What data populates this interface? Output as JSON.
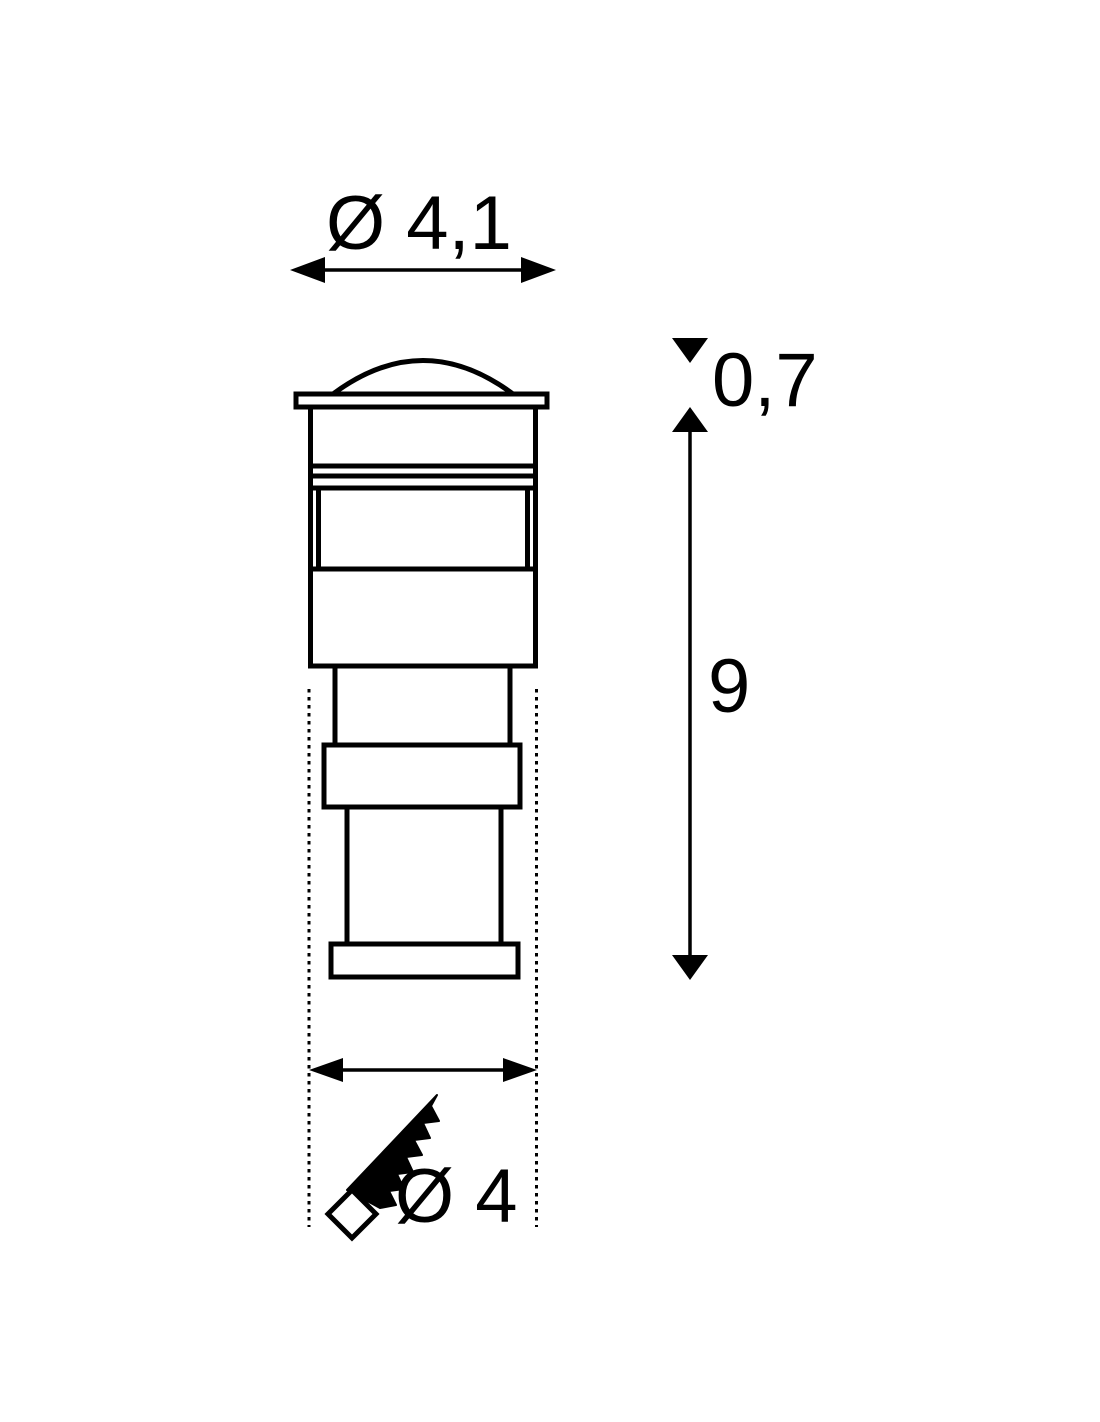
{
  "canvas": {
    "background": "#ffffff",
    "ink": "#000000"
  },
  "dimension_labels": {
    "top_diameter": "Ø 4,1",
    "protrusion_height": "0,7",
    "recessed_depth": "9",
    "bottom_diameter": "Ø 4"
  },
  "icons": {
    "ground_cut": "saw-arrow-with-diamond-tip-icon"
  }
}
